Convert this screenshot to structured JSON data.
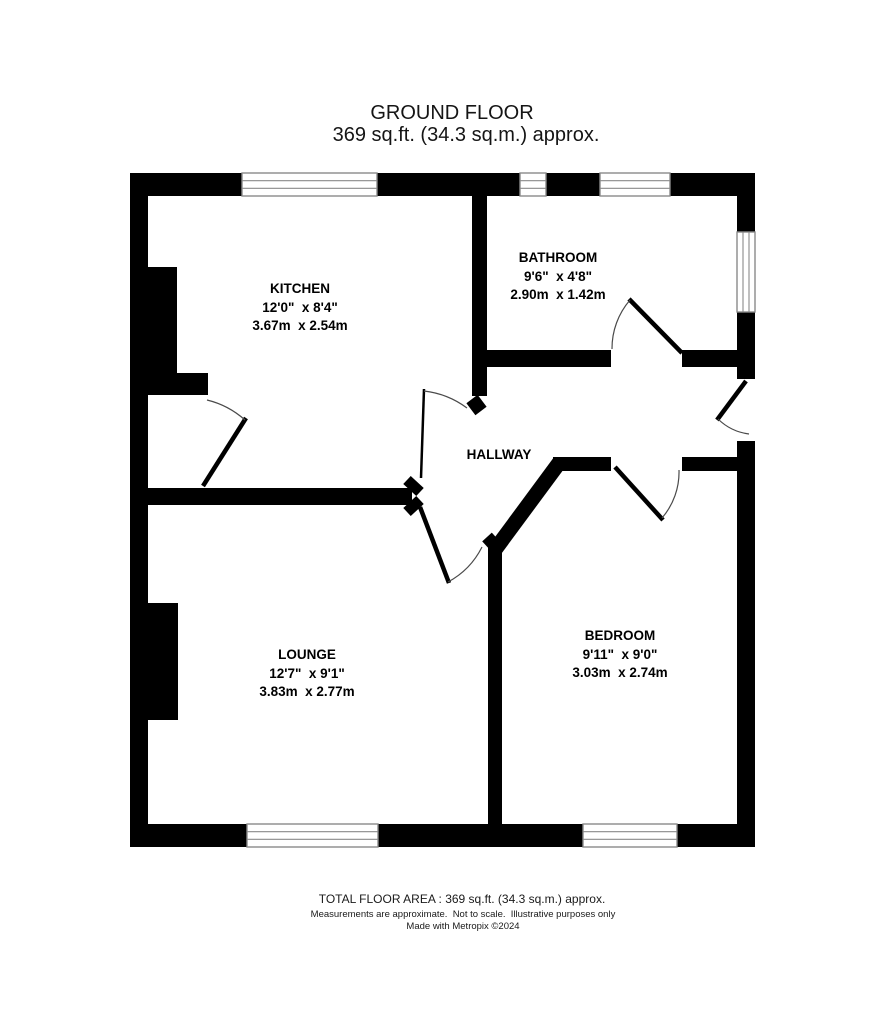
{
  "header": {
    "title": "GROUND FLOOR",
    "subtitle": "369 sq.ft. (34.3 sq.m.) approx."
  },
  "rooms": {
    "kitchen": {
      "name": "KITCHEN",
      "imperial": "12'0\"  x 8'4\"",
      "metric": "3.67m  x 2.54m"
    },
    "bathroom": {
      "name": "BATHROOM",
      "imperial": "9'6\"  x 4'8\"",
      "metric": "2.90m  x 1.42m"
    },
    "hallway": {
      "name": "HALLWAY"
    },
    "lounge": {
      "name": "LOUNGE",
      "imperial": "12'7\"  x 9'1\"",
      "metric": "3.83m  x 2.77m"
    },
    "bedroom": {
      "name": "BEDROOM",
      "imperial": "9'11\"  x 9'0\"",
      "metric": "3.03m  x 2.74m"
    }
  },
  "footer": {
    "total_area": "TOTAL FLOOR AREA : 369 sq.ft. (34.3 sq.m.) approx.",
    "disclaimer": "Measurements are approximate.  Not to scale.  Illustrative purposes only",
    "credit": "Made with Metropix ©2024"
  },
  "colors": {
    "wall": "#000000",
    "window_frame": "#8a8a8a",
    "background": "#ffffff"
  }
}
